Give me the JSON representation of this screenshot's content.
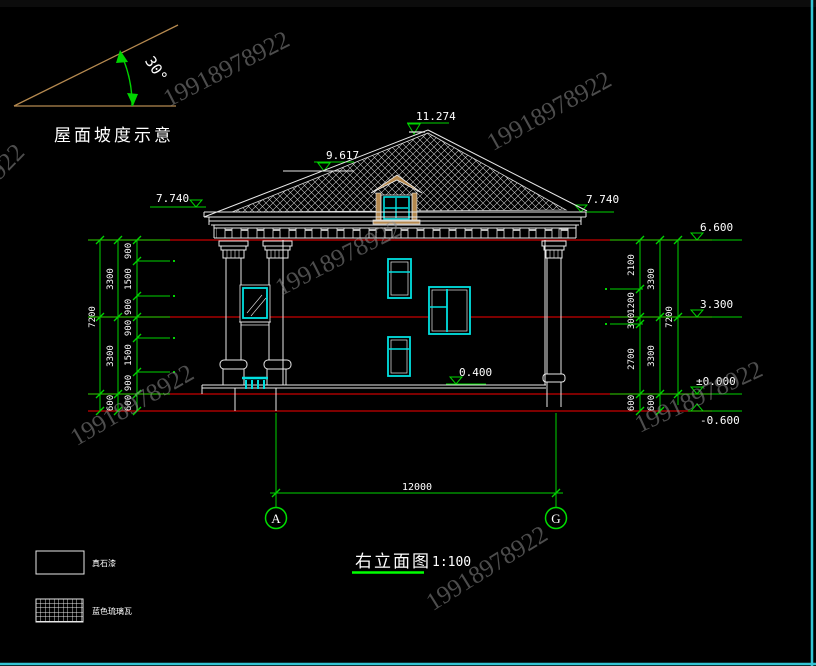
{
  "watermark": {
    "text": "19918978922"
  },
  "slope_diagram": {
    "angle": "30°",
    "caption": "屋面坡度示意"
  },
  "markers": {
    "ridge": "11.274",
    "roof_break": "9.617",
    "eave_left": "7.740",
    "eave_right": "7.740",
    "level2_top": "6.600",
    "level1_top": "3.300",
    "ground": "±0.000",
    "below_ground": "-0.600",
    "porch_floor": "0.400"
  },
  "dims": {
    "left_outer": [
      "7200"
    ],
    "left_mid": [
      "3300",
      "3300",
      "600"
    ],
    "left_inner": [
      "900",
      "1500",
      "900",
      "900",
      "1500",
      "900",
      "600"
    ],
    "right_inner": [
      "2100",
      "1200",
      "300",
      "2700",
      "600"
    ],
    "right_mid": [
      "3300",
      "3300",
      "600"
    ],
    "right_outer": [
      "7200"
    ],
    "overall_width": "12000"
  },
  "grid": {
    "left": "A",
    "right": "G"
  },
  "title": {
    "name": "右立面图",
    "scale": "1:100"
  },
  "legend": [
    {
      "swatch": "plain",
      "label": "真石漆"
    },
    {
      "swatch": "hatch",
      "label": "蓝色琉璃瓦"
    }
  ],
  "colors": {
    "dimension_green": "#00d400",
    "bright_green": "#00ff00",
    "level_red": "#c80000",
    "window_cyan": "#00e0e0",
    "wood_tan": "#b5894f",
    "border_cyan": "#35c4d4",
    "watermark_gray": "#8d8d8d"
  }
}
